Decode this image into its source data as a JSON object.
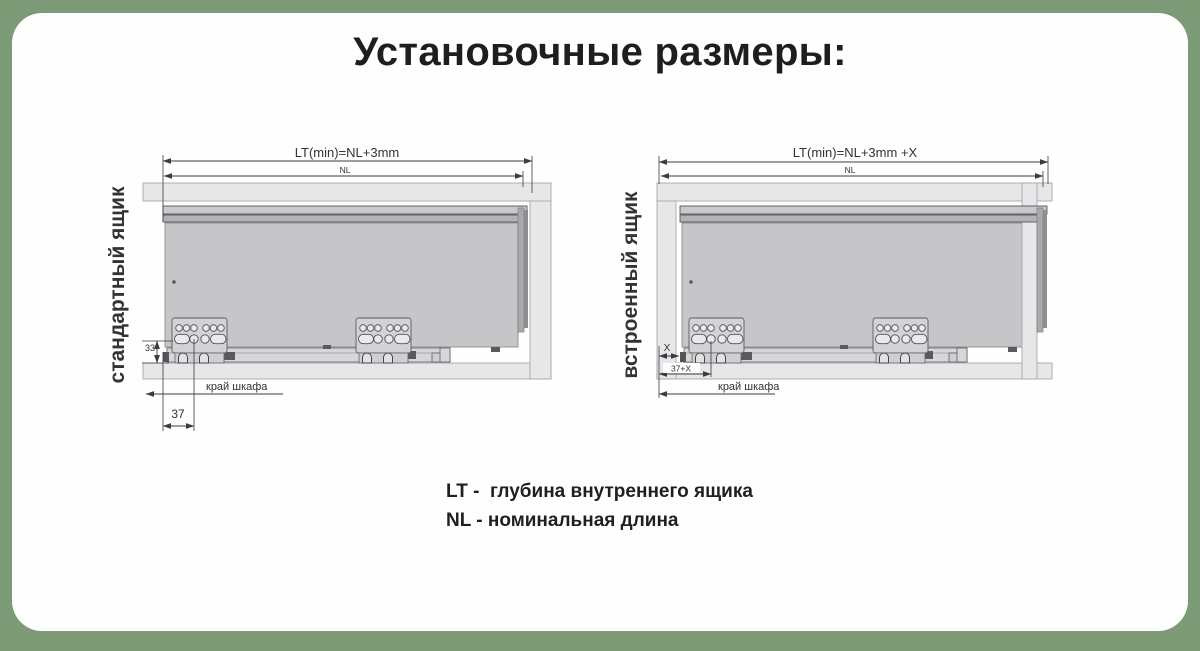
{
  "title": "Установочные размеры:",
  "colors": {
    "background": "#7d9a76",
    "card": "#fdfefd",
    "cabinet_panel": "#e7e7e9",
    "drawer_panel": "#c6c6c8",
    "dimension_lines": "#3c3c40"
  },
  "diagrams": {
    "standard": {
      "label": "стандартный ящик",
      "dim_lt": "LT(min)=NL+3mm",
      "dim_nl": "NL",
      "dim_height": "33",
      "dim_front": "37",
      "cabinet_edge": "край шкафа"
    },
    "builtin": {
      "label": "встроенный ящик",
      "dim_lt": "LT(min)=NL+3mm +X",
      "dim_nl": "NL",
      "dim_inset": "X",
      "dim_front": "37+X",
      "cabinet_edge": "край шкафа"
    }
  },
  "legend": {
    "items": [
      "LT -  глубина внутреннего ящика",
      "NL - номинальная длина"
    ]
  }
}
